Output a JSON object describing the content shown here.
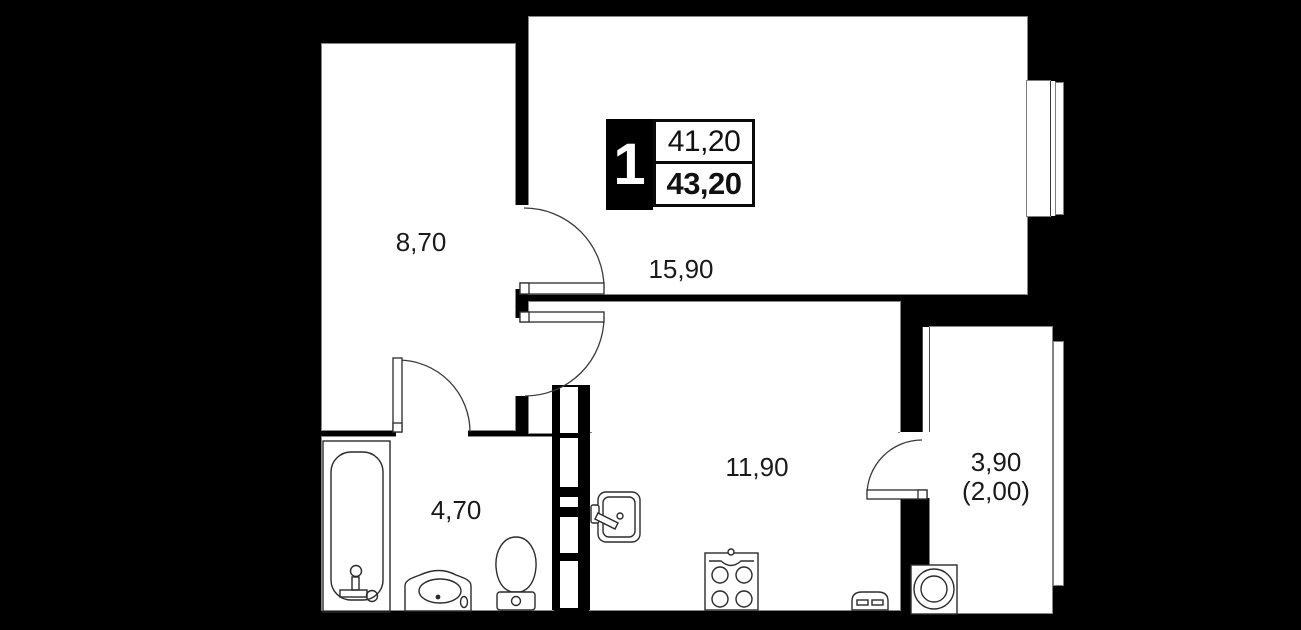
{
  "floor_plan": {
    "type": "apartment-floor-plan",
    "unit_badge": {
      "rooms_count": "1",
      "area_living": "41,20",
      "area_total": "43,20"
    },
    "rooms": [
      {
        "name": "hallway",
        "area": "8,70"
      },
      {
        "name": "living-room",
        "area": "15,90"
      },
      {
        "name": "kitchen",
        "area": "11,90"
      },
      {
        "name": "bathroom",
        "area": "4,70"
      },
      {
        "name": "balcony",
        "area": "3,90",
        "area_reduced": "(2,00)"
      }
    ],
    "fixtures": [
      "bathtub-icon",
      "vanity-sink-icon",
      "toilet-icon",
      "kitchen-sink-icon",
      "stove-icon",
      "radiator-icon",
      "washing-machine-icon"
    ],
    "colors": {
      "background": "#000000",
      "room_fill": "#ffffff",
      "wall": "#000000",
      "line": "#2b2b2b",
      "edge": "#858585"
    }
  }
}
